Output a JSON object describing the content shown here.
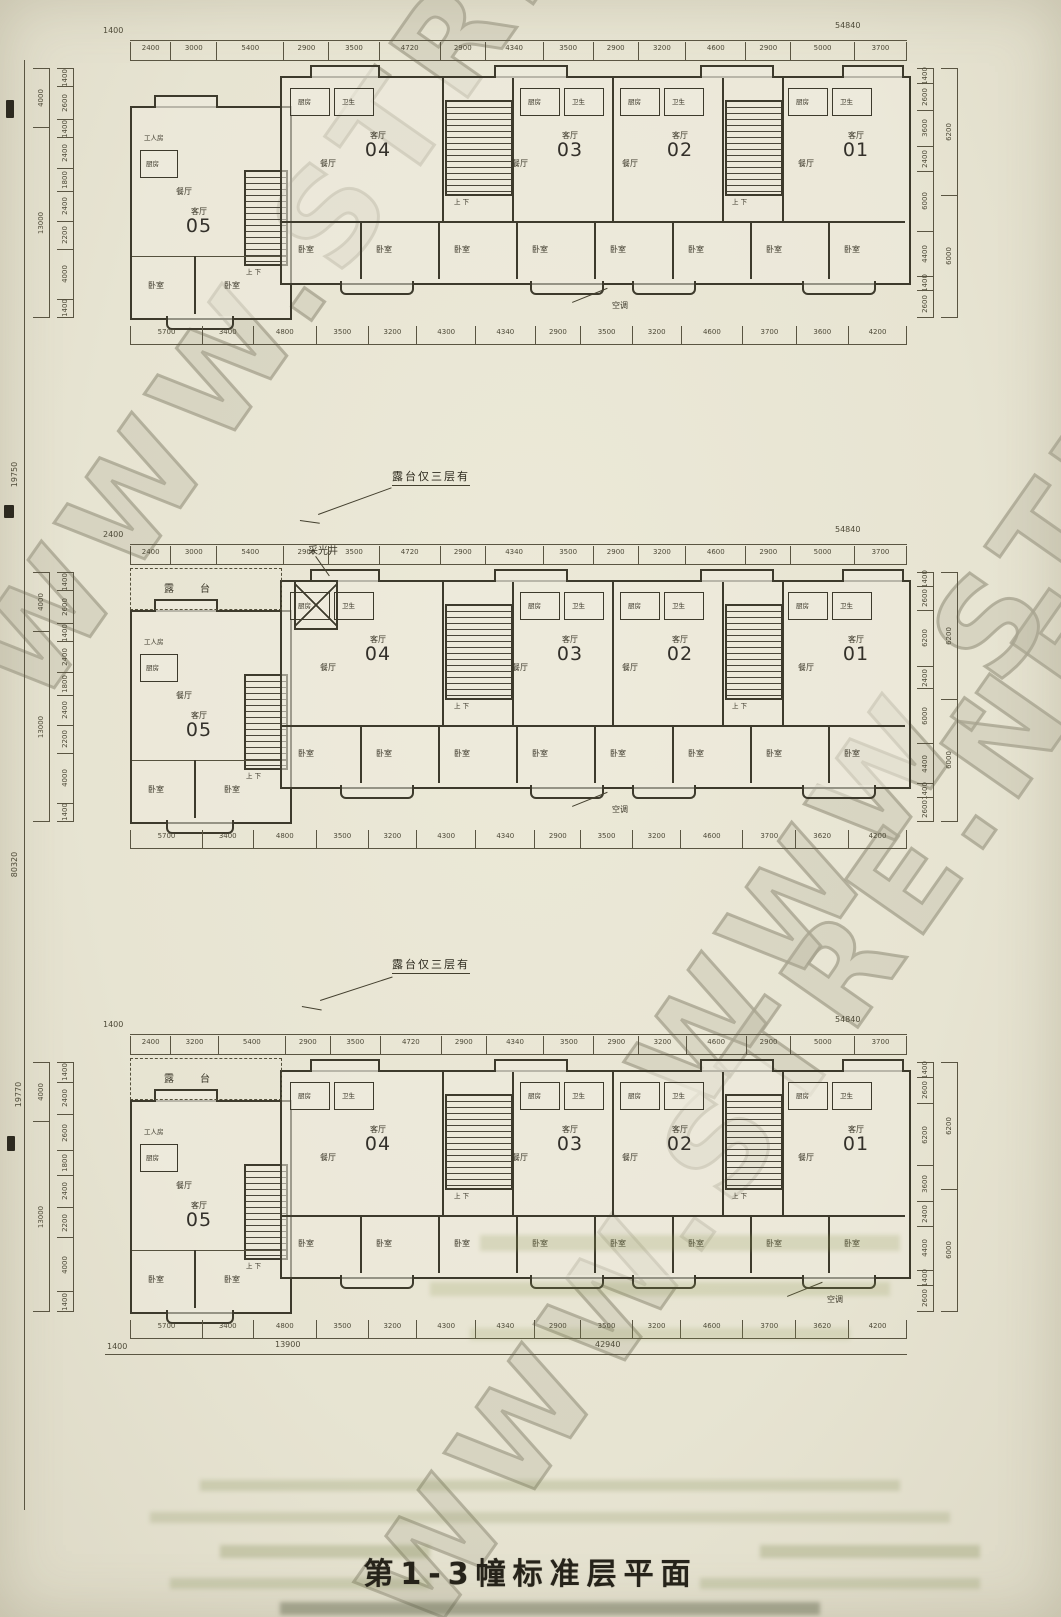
{
  "page": {
    "title": "第1-3幢标准层平面",
    "watermark": "WWW.STRE.NET"
  },
  "labels": {
    "living": "客厅",
    "dining": "餐厅",
    "bedroom": "卧室",
    "kitchen": "厨房",
    "bath": "卫生",
    "worker_room": "工人房",
    "terrace": "露台",
    "terrace_spread": "露  台",
    "terrace_note": "露台仅三层有",
    "light_well": "采光井",
    "ac": "空调",
    "stair_updown": "上 下"
  },
  "overall_dims": {
    "left_totals": [
      "19750",
      "80320",
      "19770"
    ],
    "left_groups": [
      "4000",
      "13000"
    ],
    "right_groups": [
      "6200",
      "6000"
    ],
    "top_left_offset": "1400",
    "top_total": "54840"
  },
  "plans": [
    {
      "name": "plan-1",
      "unit_numbers": [
        "05",
        "04",
        "03",
        "02",
        "01"
      ],
      "top_total": "54840",
      "top_left_offset": "1400",
      "top_segments": [
        "2400",
        "3000",
        "5400",
        "2900",
        "3500",
        "4720",
        "2900",
        "4340",
        "3500",
        "2900",
        "3200",
        "4600",
        "2900",
        "5000",
        "3700"
      ],
      "bottom_segments": [
        "5700",
        "3400",
        "4800",
        "3500",
        "3200",
        "4300",
        "4340",
        "2900",
        "3500",
        "3200",
        "4600",
        "3700",
        "3600",
        "4200"
      ],
      "left_segments": [
        "1400",
        "2600",
        "1400",
        "2400",
        "1800",
        "2400",
        "2200",
        "4000",
        "1400"
      ],
      "left_groups": [
        "4000",
        "13000"
      ],
      "right_segments": [
        "1400",
        "2600",
        "3600",
        "2400",
        "6000",
        "4400",
        "1400",
        "2600"
      ],
      "right_groups": [
        "6200",
        "6000"
      ],
      "has_lightwell": false,
      "has_terrace": false
    },
    {
      "name": "plan-2",
      "unit_numbers": [
        "05",
        "04",
        "03",
        "02",
        "01"
      ],
      "top_total": "54840",
      "top_left_offset": "2400",
      "top_segments": [
        "2400",
        "3000",
        "5400",
        "2900",
        "3500",
        "4720",
        "2900",
        "4340",
        "3500",
        "2900",
        "3200",
        "4600",
        "2900",
        "5000",
        "3700"
      ],
      "bottom_segments": [
        "5700",
        "3400",
        "4800",
        "3500",
        "3200",
        "4300",
        "4340",
        "2900",
        "3500",
        "3200",
        "4600",
        "3700",
        "3620",
        "4200"
      ],
      "left_segments": [
        "1400",
        "2600",
        "1400",
        "2400",
        "1800",
        "2400",
        "2200",
        "4000",
        "1400"
      ],
      "left_groups": [
        "4000",
        "13000"
      ],
      "right_segments": [
        "1400",
        "2600",
        "6200",
        "2400",
        "6000",
        "4400",
        "1400",
        "2600"
      ],
      "right_groups": [
        "6200",
        "6000"
      ],
      "has_lightwell": true,
      "has_terrace": true
    },
    {
      "name": "plan-3",
      "unit_numbers": [
        "05",
        "04",
        "03",
        "02",
        "01"
      ],
      "top_total": "54840",
      "top_left_offset": "1400",
      "top_segments": [
        "2400",
        "3200",
        "5400",
        "2900",
        "3500",
        "4720",
        "2900",
        "4340",
        "3500",
        "2900",
        "3200",
        "4600",
        "2900",
        "5000",
        "3700"
      ],
      "bottom_segments": [
        "5700",
        "3400",
        "4800",
        "3500",
        "3200",
        "4300",
        "4340",
        "2900",
        "3500",
        "3200",
        "4600",
        "3700",
        "3620",
        "4200"
      ],
      "bottom_totals": {
        "left_offset": "1400",
        "left_group": "13900",
        "right_group": "42940"
      },
      "left_segments": [
        "1400",
        "2400",
        "2600",
        "1800",
        "2400",
        "2200",
        "4000",
        "1400"
      ],
      "left_groups": [
        "4000",
        "13000"
      ],
      "right_segments": [
        "1400",
        "2600",
        "6200",
        "3600",
        "2400",
        "4400",
        "1400",
        "2600"
      ],
      "right_groups": [
        "6200",
        "6000"
      ],
      "has_lightwell": false,
      "has_terrace": true
    }
  ],
  "annotations": [
    {
      "id": "terrace-note-1",
      "text": "露台仅三层有"
    },
    {
      "id": "terrace-note-2",
      "text": "露台仅三层有"
    }
  ]
}
